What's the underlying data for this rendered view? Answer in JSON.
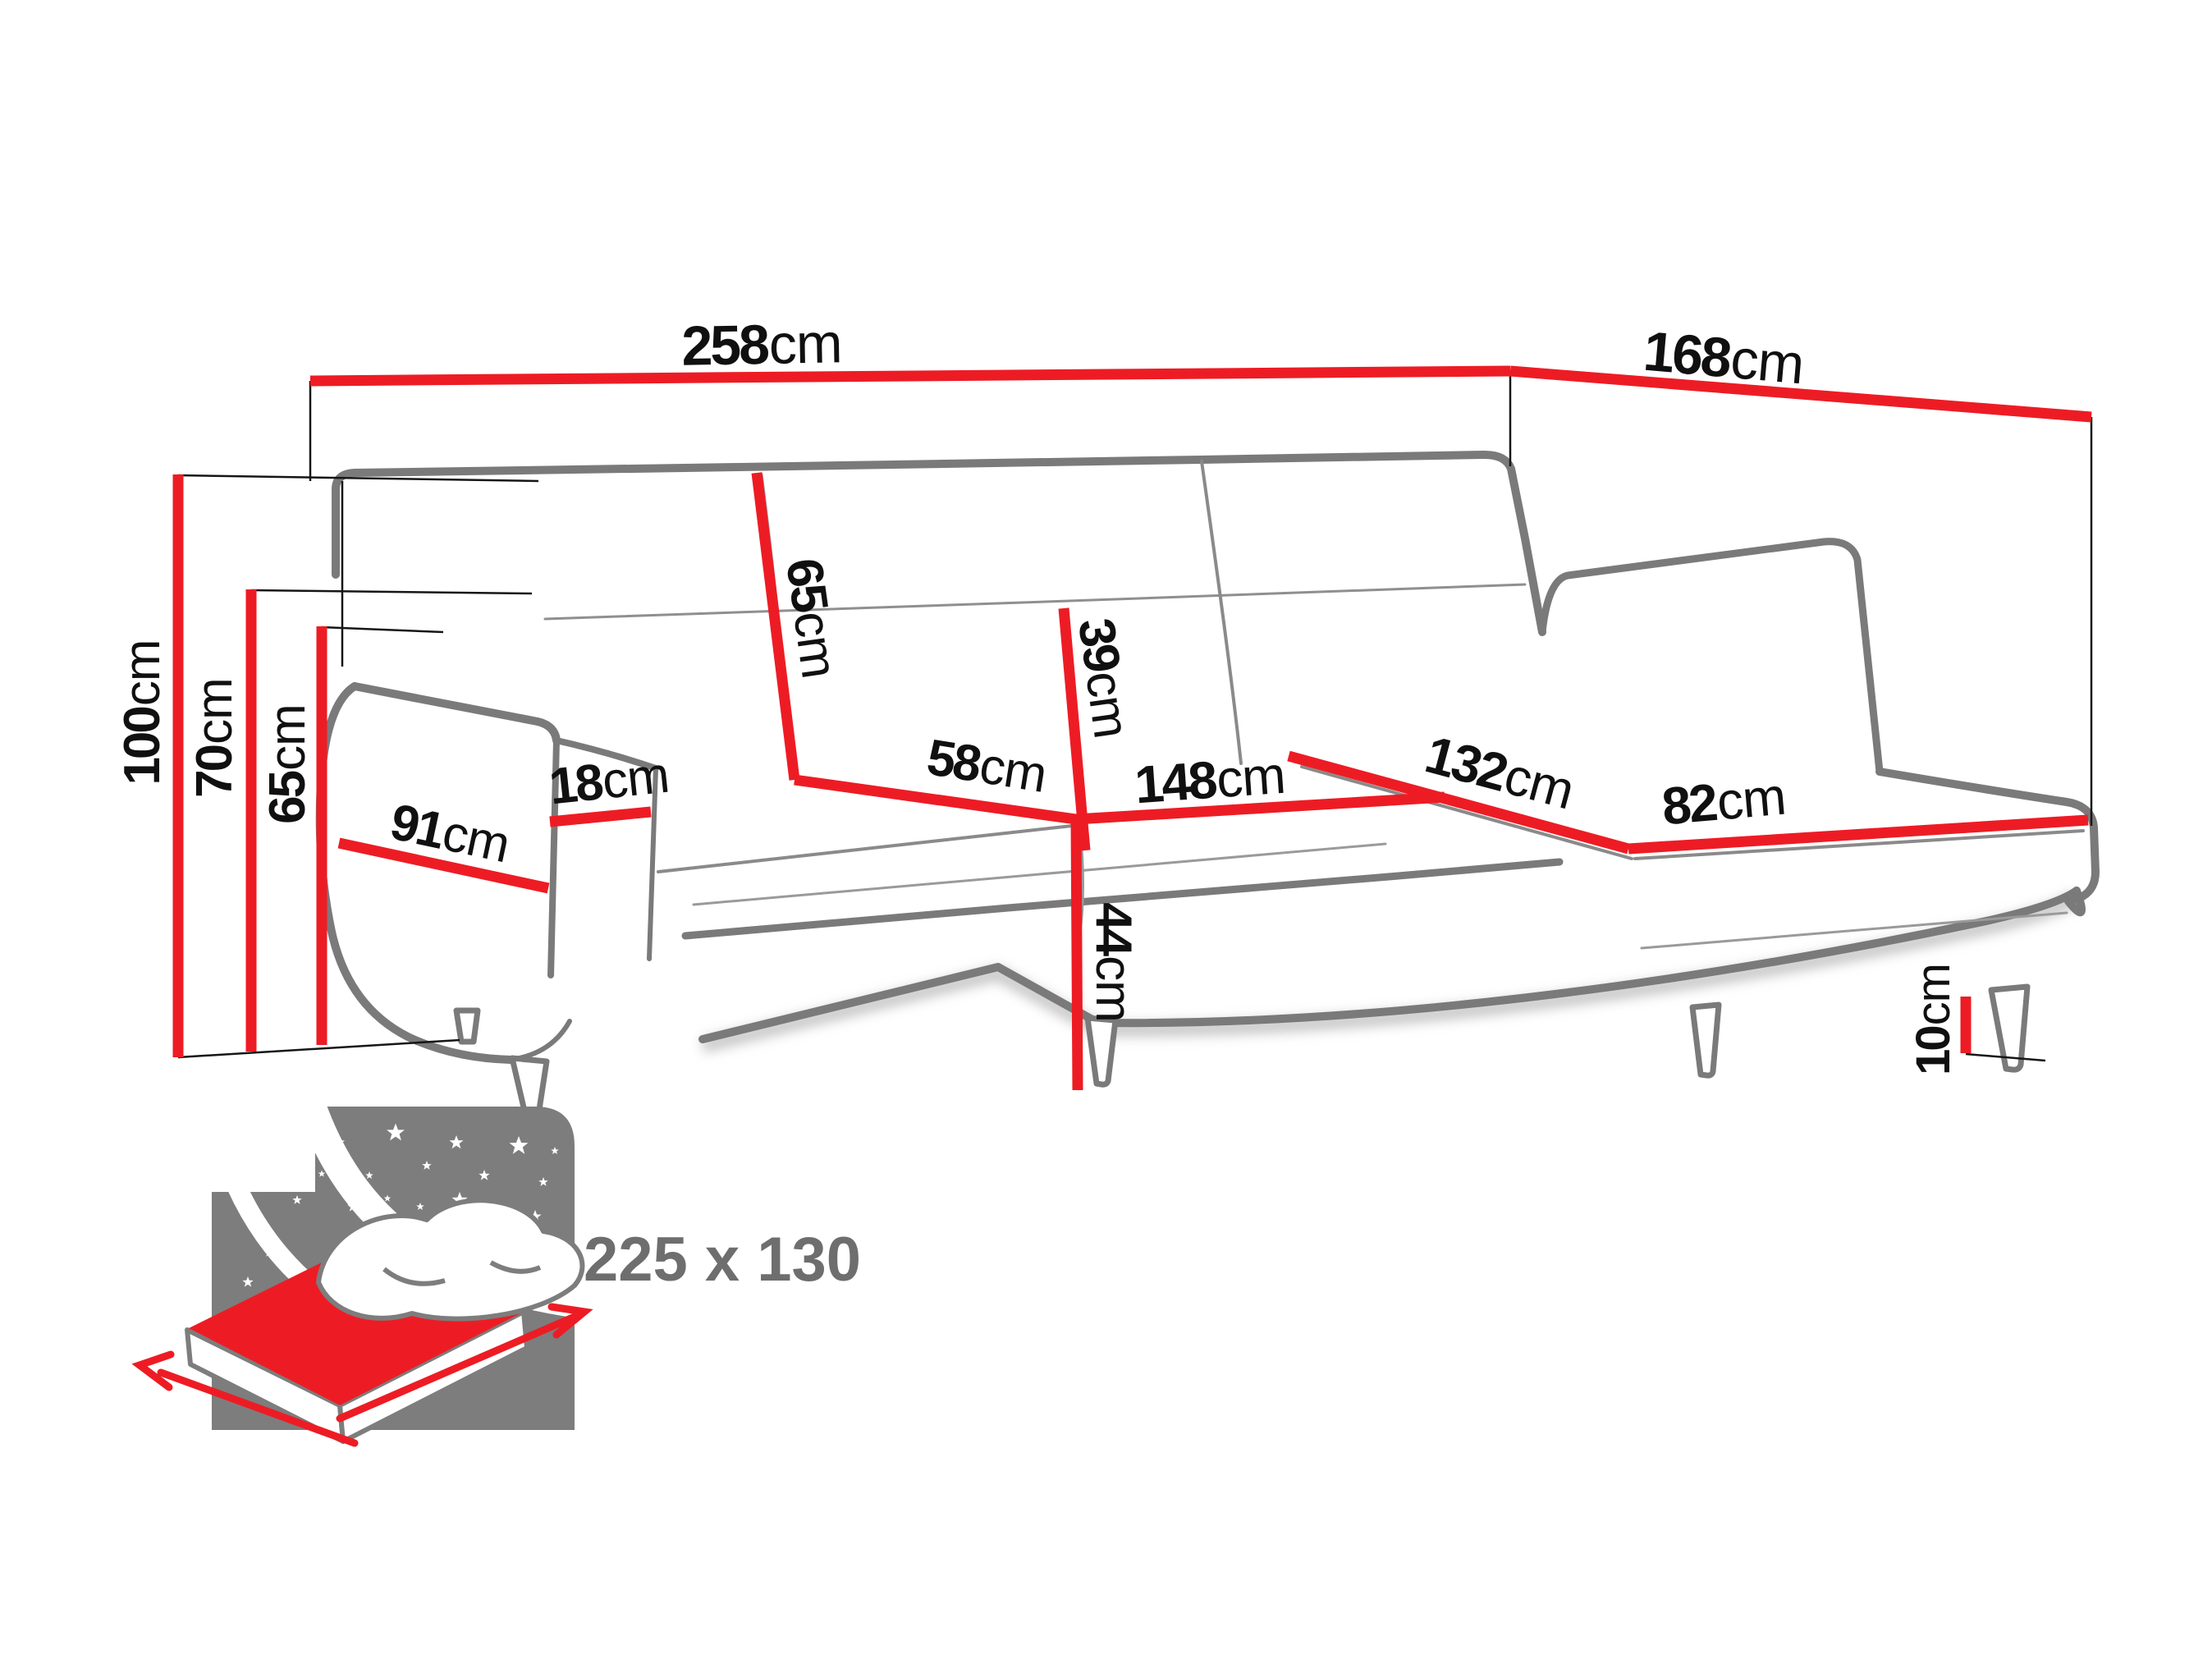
{
  "dims": {
    "total_width": {
      "value": "258",
      "unit": "cm"
    },
    "total_depth": {
      "value": "168",
      "unit": "cm"
    },
    "total_height": {
      "value": "100",
      "unit": "cm"
    },
    "arm_height": {
      "value": "70",
      "unit": "cm"
    },
    "side_height": {
      "value": "65",
      "unit": "cm"
    },
    "arm_depth": {
      "value": "91",
      "unit": "cm"
    },
    "arm_width": {
      "value": "18",
      "unit": "cm"
    },
    "backrest_height": {
      "value": "65",
      "unit": "cm"
    },
    "headrest_height": {
      "value": "39",
      "unit": "cm"
    },
    "seat_depth": {
      "value": "58",
      "unit": "cm"
    },
    "seat_width": {
      "value": "148",
      "unit": "cm"
    },
    "chaise_length": {
      "value": "132",
      "unit": "cm"
    },
    "chaise_width": {
      "value": "82",
      "unit": "cm"
    },
    "seat_height": {
      "value": "44",
      "unit": "cm"
    },
    "leg_height": {
      "value": "10",
      "unit": "cm"
    }
  },
  "bed": {
    "size_label": "225 x 130"
  },
  "colors": {
    "dimension_red": "#ed1c24",
    "outline_gray": "#7a7a7a",
    "bed_gray": "#7d7d7d",
    "text_black": "#101010",
    "bed_text_gray": "#6e6e6e"
  }
}
